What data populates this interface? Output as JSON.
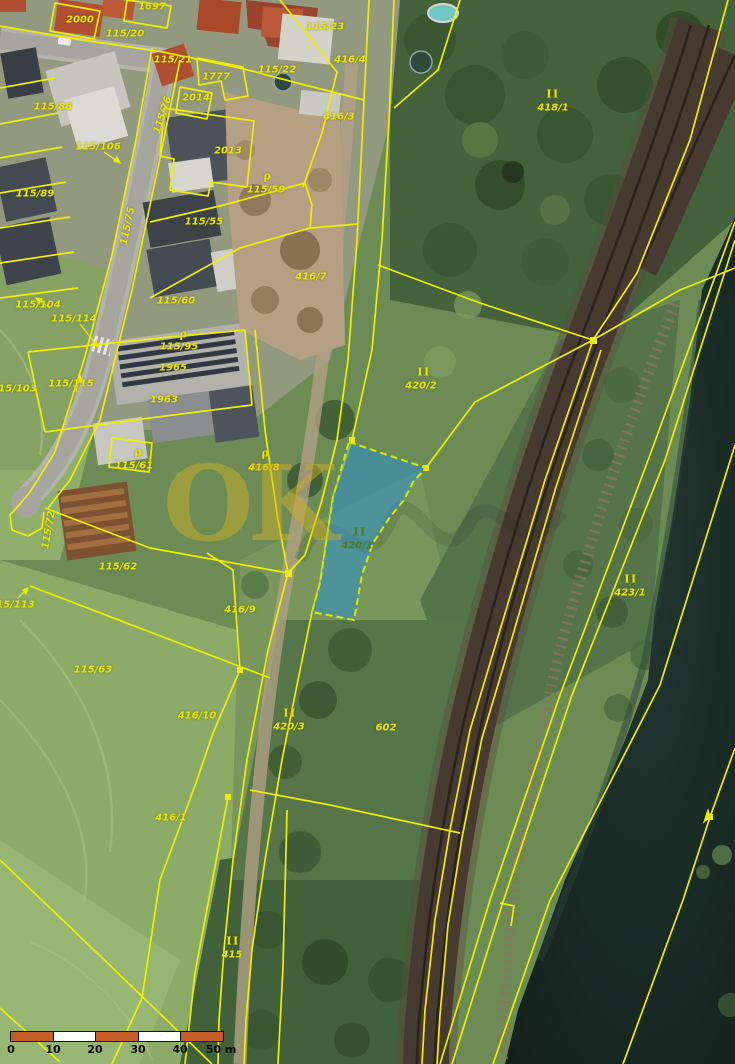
{
  "watermark": {
    "text": "OK"
  },
  "scale_bar": {
    "tick_labels": [
      "0",
      "10",
      "20",
      "30",
      "40",
      "50 m"
    ],
    "bar_color": "#c75b2a",
    "alt_color": "#ffffff"
  },
  "map": {
    "line_color": "#f0ee00",
    "label_color": "#ebe600",
    "highlighted_parcel": {
      "id": "420/1",
      "fill": "#2b8fcd",
      "border": "#d9e900"
    },
    "parcel_labels": [
      {
        "t": "2000",
        "x": 80,
        "y": 20
      },
      {
        "t": "1697",
        "x": 152,
        "y": 7
      },
      {
        "t": "115/20",
        "x": 125,
        "y": 34
      },
      {
        "t": "115/21",
        "x": 173,
        "y": 60
      },
      {
        "t": "1777",
        "x": 216,
        "y": 77
      },
      {
        "t": "2014",
        "x": 196,
        "y": 98
      },
      {
        "t": "2013",
        "x": 228,
        "y": 151
      },
      {
        "t": "115/22",
        "x": 277,
        "y": 70
      },
      {
        "t": "115/23",
        "x": 325,
        "y": 27
      },
      {
        "t": "416/4",
        "x": 350,
        "y": 60
      },
      {
        "t": "416/3",
        "x": 339,
        "y": 117
      },
      {
        "t": "115/88",
        "x": 53,
        "y": 107
      },
      {
        "t": "115/106",
        "x": 98,
        "y": 147
      },
      {
        "t": "115/89",
        "x": 35,
        "y": 194
      },
      {
        "t": "115/76",
        "x": 163,
        "y": 115,
        "r": -72
      },
      {
        "t": "ρ",
        "x": 268,
        "y": 176,
        "k": "sym"
      },
      {
        "t": "115/59",
        "x": 266,
        "y": 190
      },
      {
        "t": "II",
        "x": 553,
        "y": 94,
        "k": "sym"
      },
      {
        "t": "418/1",
        "x": 553,
        "y": 108
      },
      {
        "t": "115/55",
        "x": 204,
        "y": 222
      },
      {
        "t": "115/75",
        "x": 128,
        "y": 226,
        "r": -78
      },
      {
        "t": "416/7",
        "x": 311,
        "y": 277
      },
      {
        "t": "115/60",
        "x": 176,
        "y": 301
      },
      {
        "t": "ρ",
        "x": 184,
        "y": 334,
        "k": "sym"
      },
      {
        "t": "115/95",
        "x": 179,
        "y": 347
      },
      {
        "t": "1965",
        "x": 173,
        "y": 368
      },
      {
        "t": "1963",
        "x": 164,
        "y": 400
      },
      {
        "t": "115/104",
        "x": 38,
        "y": 305
      },
      {
        "t": "115/114",
        "x": 74,
        "y": 319
      },
      {
        "t": "115/103",
        "x": 14,
        "y": 389
      },
      {
        "t": "115/115",
        "x": 71,
        "y": 384
      },
      {
        "t": "ρ",
        "x": 139,
        "y": 452,
        "k": "sym"
      },
      {
        "t": "115/61",
        "x": 134,
        "y": 466
      },
      {
        "t": "ρ",
        "x": 266,
        "y": 453,
        "k": "sym"
      },
      {
        "t": "416/8",
        "x": 264,
        "y": 468
      },
      {
        "t": "115/72",
        "x": 49,
        "y": 530,
        "r": -80
      },
      {
        "t": "115/113",
        "x": 12,
        "y": 605
      },
      {
        "t": "115/62",
        "x": 118,
        "y": 567
      },
      {
        "t": "115/63",
        "x": 93,
        "y": 670
      },
      {
        "t": "416/9",
        "x": 240,
        "y": 610
      },
      {
        "t": "416/10",
        "x": 197,
        "y": 716
      },
      {
        "t": "II",
        "x": 424,
        "y": 372,
        "k": "sym"
      },
      {
        "t": "420/2",
        "x": 421,
        "y": 386
      },
      {
        "t": "II",
        "x": 360,
        "y": 532,
        "k": "symd"
      },
      {
        "t": "420/1",
        "x": 357,
        "y": 546,
        "k": "dark"
      },
      {
        "t": "II",
        "x": 290,
        "y": 713,
        "k": "sym"
      },
      {
        "t": "420/3",
        "x": 289,
        "y": 727
      },
      {
        "t": "602",
        "x": 386,
        "y": 728
      },
      {
        "t": "II",
        "x": 631,
        "y": 579,
        "k": "sym"
      },
      {
        "t": "423/1",
        "x": 630,
        "y": 593
      },
      {
        "t": "416/1",
        "x": 171,
        "y": 818
      },
      {
        "t": "II",
        "x": 233,
        "y": 941,
        "k": "sym"
      },
      {
        "t": "415",
        "x": 232,
        "y": 955
      }
    ]
  }
}
